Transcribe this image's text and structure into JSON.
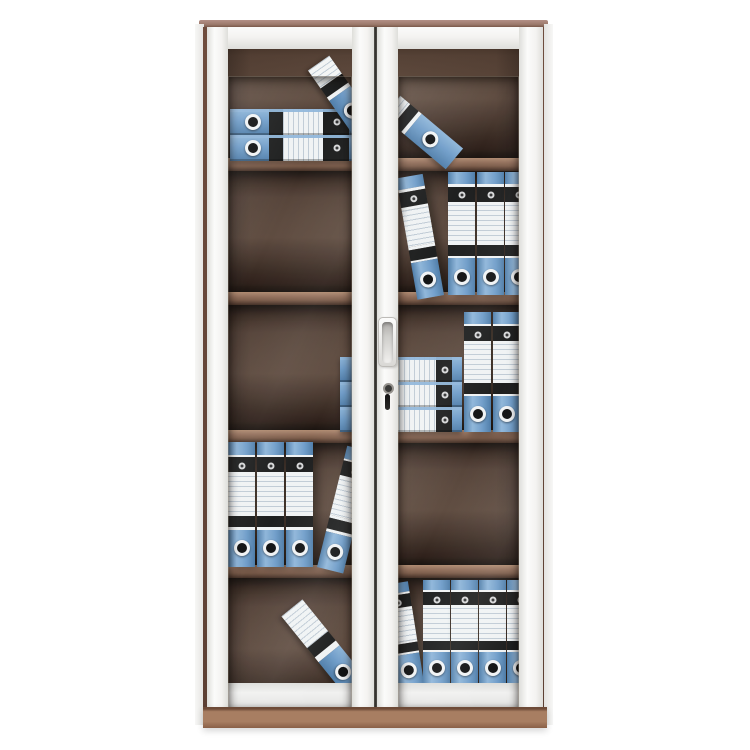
{
  "scene": {
    "description": "Product photo of a tall two-door office filing cabinet with white steel frame, framed glass doors, five interior shelves and blue lever-arch ring binders, on a plain white background",
    "background": "#ffffff"
  },
  "palette": {
    "bg": "#ffffff",
    "cabinet_top": "#9c7a6c",
    "cabinet_top_light": "#b39086",
    "carcass_edge": "#6e4c3d",
    "plinth": "#a87e62",
    "plinth_dark": "#8a6047",
    "plinth_line": "#6e4b38",
    "door_frame": "#f4f3f1",
    "door_frame_shade": "#dededa",
    "interior_top": "#564135",
    "interior_mid": "#4d392e",
    "interior_dark": "#2a1b13",
    "shelf_hi": "#b08a6e",
    "shelf_mid": "#96705a",
    "shelf_lo": "#7c5a46",
    "shelf_bottom": "#3f2a1f",
    "binder_blue": "#6f9dc9",
    "binder_blue_dark": "#4d7ca8",
    "binder_blue_light": "#8fb6da",
    "binder_black": "#181817",
    "label_white": "#f3f5f5",
    "label_line": "#c2cdd6",
    "metal_light": "#d9d9d9"
  },
  "cabinet": {
    "doors": 2,
    "shelf_count": 4,
    "handle": {
      "present": true,
      "door": "right"
    },
    "lock": {
      "present": true,
      "door": "right"
    },
    "sections": [
      {
        "top": 0,
        "height": 131
      },
      {
        "top": 144,
        "height": 121
      },
      {
        "top": 278,
        "height": 125
      },
      {
        "top": 416,
        "height": 122
      },
      {
        "top": 551,
        "height": 129
      }
    ],
    "shelf_tops": [
      131,
      265,
      403,
      538
    ]
  },
  "binder_styles": {
    "vertical": {
      "orientation": "col",
      "w": 27,
      "h": 120,
      "segs": [
        [
          "blue",
          10
        ],
        [
          "wline",
          2
        ],
        [
          "black",
          12
        ],
        [
          "wline",
          3
        ],
        [
          "label",
          30
        ],
        [
          "wline",
          2
        ],
        [
          "black",
          9
        ],
        [
          "wline",
          2
        ],
        [
          "blue",
          30
        ]
      ],
      "deco": [
        [
          "eyelet",
          50,
          19
        ],
        [
          "hole",
          50,
          85
        ]
      ]
    },
    "flat": {
      "orientation": "row",
      "w": 155,
      "h": 26,
      "segs": [
        [
          "blue",
          25
        ],
        [
          "black",
          9
        ],
        [
          "label",
          26
        ],
        [
          "black",
          17
        ],
        [
          "blue",
          23
        ]
      ],
      "deco": [
        [
          "hole",
          15,
          50
        ],
        [
          "eyelet",
          69,
          50
        ]
      ],
      "cap": true
    },
    "flat2": {
      "orientation": "row",
      "w": 122,
      "h": 25,
      "segs": [
        [
          "blue",
          20
        ],
        [
          "label",
          59
        ],
        [
          "black",
          13
        ],
        [
          "blue",
          8
        ]
      ],
      "deco": [
        [
          "eyelet",
          86,
          50
        ]
      ],
      "cap": true
    },
    "fraga": {
      "orientation": "row",
      "w": 78,
      "h": 26,
      "segs": [
        [
          "label",
          28
        ],
        [
          "black",
          14
        ],
        [
          "wline",
          6
        ],
        [
          "blue",
          52
        ]
      ],
      "deco": [
        [
          "hole",
          74,
          50
        ]
      ]
    },
    "fragb": {
      "orientation": "row",
      "w": 82,
      "h": 27,
      "segs": [
        [
          "label",
          16
        ],
        [
          "black",
          13
        ],
        [
          "wline",
          5
        ],
        [
          "blue",
          66
        ]
      ],
      "deco": [
        [
          "hole",
          62,
          50
        ]
      ]
    },
    "fragc": {
      "orientation": "row",
      "w": 102,
      "h": 27,
      "segs": [
        [
          "label",
          40
        ],
        [
          "black",
          12
        ],
        [
          "wline",
          6
        ],
        [
          "blue",
          42
        ]
      ],
      "deco": [
        [
          "hole",
          80,
          50
        ]
      ]
    }
  },
  "binders": {
    "items": [
      {
        "row": 1,
        "kind": "flat",
        "x": 23,
        "y": 82
      },
      {
        "row": 1,
        "kind": "flat",
        "x": 23,
        "y": 108
      },
      {
        "row": 1,
        "kind": "fraga",
        "x": 95,
        "y": 55,
        "rot": 55
      },
      {
        "row": 1,
        "kind": "fragb",
        "x": 175,
        "y": 92,
        "rot": 40
      },
      {
        "row": 2,
        "kind": "vertical",
        "x": 210,
        "y": 145,
        "h": 123,
        "rot": -10,
        "origin": "100% 100%"
      },
      {
        "row": 2,
        "kind": "vertical",
        "x": 241,
        "y": 145,
        "h": 123
      },
      {
        "row": 2,
        "kind": "vertical",
        "x": 270,
        "y": 145,
        "h": 123
      },
      {
        "row": 2,
        "kind": "vertical",
        "x": 298,
        "y": 145,
        "h": 123
      },
      {
        "row": 3,
        "kind": "flat2",
        "x": 133,
        "y": 330
      },
      {
        "row": 3,
        "kind": "flat2",
        "x": 133,
        "y": 355
      },
      {
        "row": 3,
        "kind": "flat2",
        "x": 133,
        "y": 380
      },
      {
        "row": 3,
        "kind": "vertical",
        "x": 257,
        "y": 285,
        "h": 120
      },
      {
        "row": 3,
        "kind": "vertical",
        "x": 286,
        "y": 285,
        "h": 120
      },
      {
        "row": 4,
        "kind": "vertical",
        "x": 21,
        "y": 415,
        "h": 125
      },
      {
        "row": 4,
        "kind": "vertical",
        "x": 50,
        "y": 415,
        "h": 125
      },
      {
        "row": 4,
        "kind": "vertical",
        "x": 79,
        "y": 415,
        "h": 125
      },
      {
        "row": 4,
        "kind": "vertical",
        "x": 110,
        "y": 415,
        "h": 125,
        "rot": 14,
        "origin": "0% 100%"
      },
      {
        "row": 5,
        "kind": "fragc",
        "x": 66,
        "y": 607,
        "rot": 51
      },
      {
        "row": 5,
        "kind": "vertical",
        "x": 190,
        "y": 553,
        "h": 103,
        "rot": -9,
        "origin": "100% 100%"
      },
      {
        "row": 5,
        "kind": "vertical",
        "x": 216,
        "y": 553,
        "h": 103
      },
      {
        "row": 5,
        "kind": "vertical",
        "x": 244,
        "y": 553,
        "h": 103
      },
      {
        "row": 5,
        "kind": "vertical",
        "x": 272,
        "y": 553,
        "h": 103
      },
      {
        "row": 5,
        "kind": "vertical",
        "x": 300,
        "y": 553,
        "h": 103
      }
    ]
  }
}
